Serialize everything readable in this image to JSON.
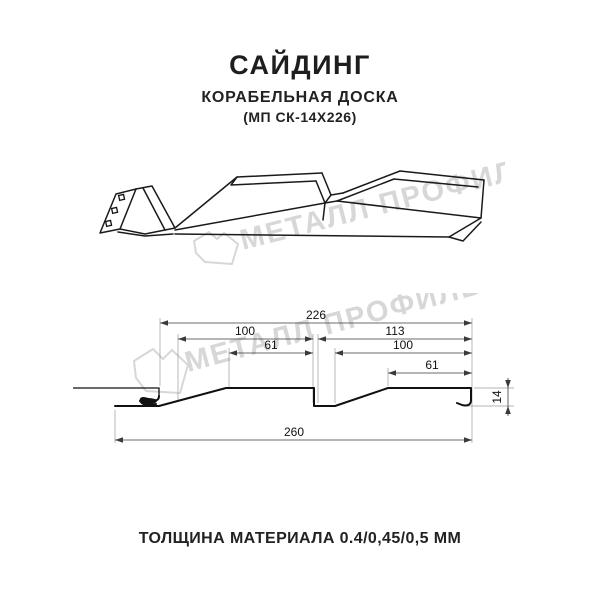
{
  "header": {
    "title": "САЙДИНГ",
    "subtitle": "КОРАБЕЛЬНАЯ ДОСКА",
    "model_code": "(МП СК-14Х226)"
  },
  "watermark": {
    "brand_text": "МЕТАЛЛ ПРОФИЛЬ",
    "color": "#d7d7d7"
  },
  "diagram": {
    "type": "technical-profile-drawing",
    "product": "Сайдинг Корабельная Доска — профиль",
    "dimensions_mm": {
      "top_total": "226",
      "upper_left": "100",
      "upper_right": "113",
      "inner_left": "61",
      "inner_right": "100",
      "right_flat": "61",
      "bottom_total": "260",
      "profile_height": "14"
    }
  },
  "footer": {
    "thickness_text": "ТОЛЩИНА МАТЕРИАЛА 0.4/0,45/0,5 ММ"
  }
}
